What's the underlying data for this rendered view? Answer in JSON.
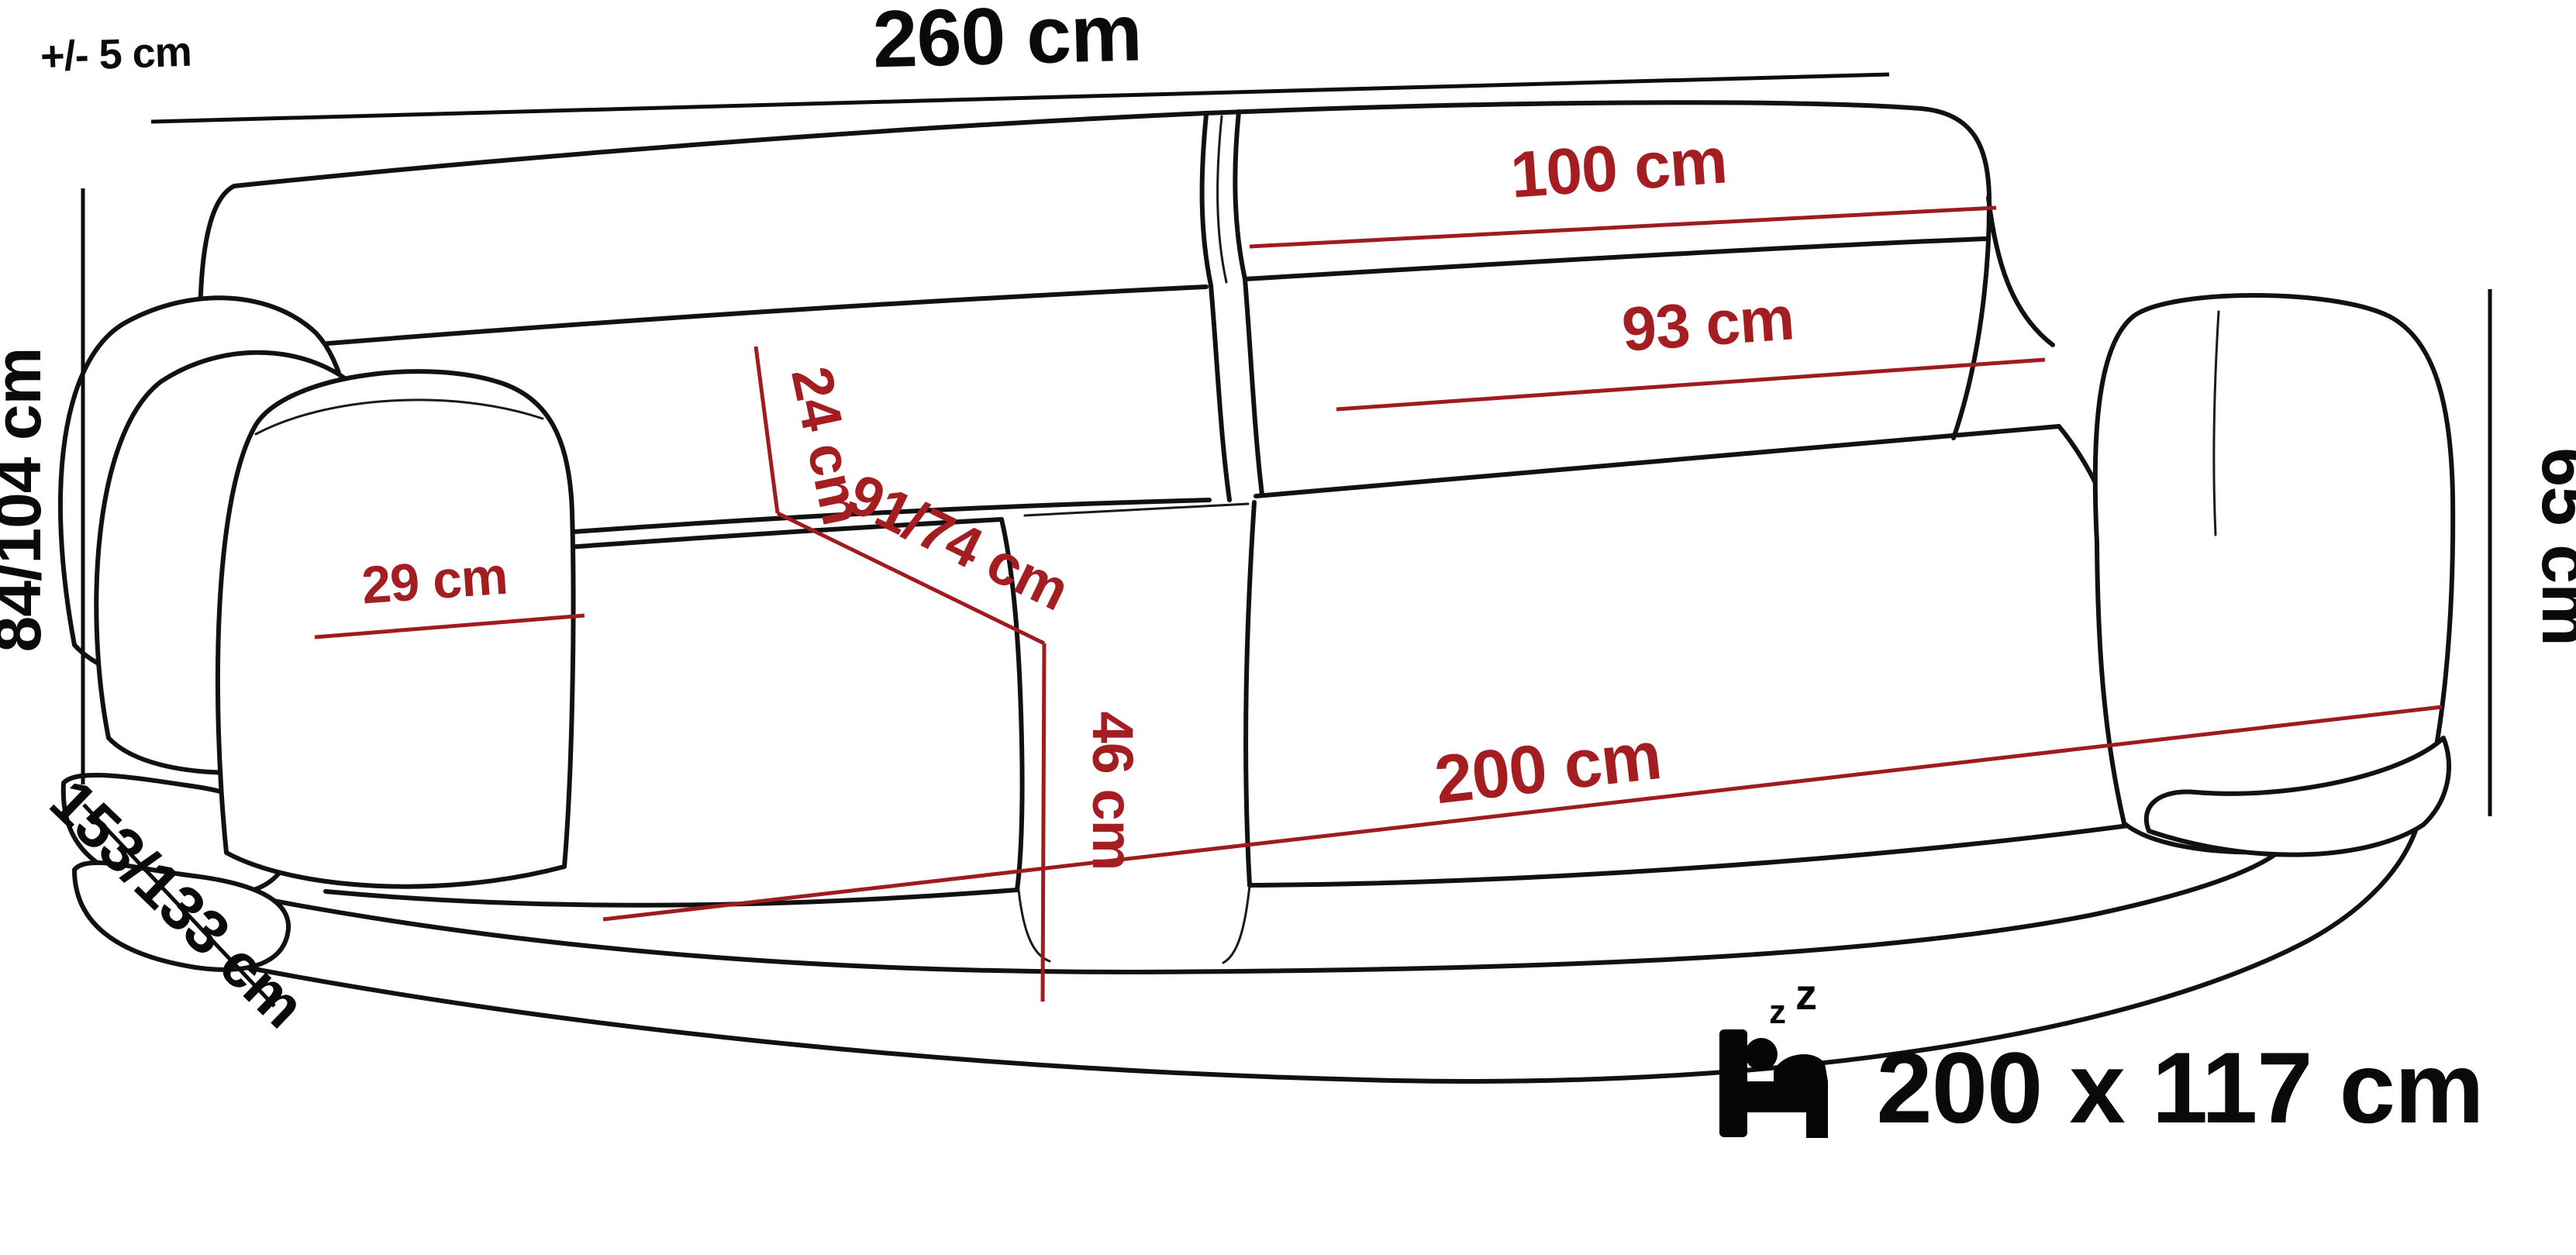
{
  "labels": {
    "tolerance": "+/- 5 cm",
    "width_total": "260 cm",
    "height_range": "84/104 cm",
    "depth_range": "153/133 cm",
    "arm_height": "65 cm",
    "headrest_width": "100 cm",
    "backrest_width": "93 cm",
    "armrest_width": "29 cm",
    "headrest_height": "24 cm",
    "seat_depth": "91/74 cm",
    "seat_height": "46 cm",
    "seat_width": "200 cm",
    "sleeping_area": "200 x 117 cm",
    "zzz_small": "z",
    "zzz_large": "z"
  },
  "colors": {
    "background": "#ffffff",
    "line_black": "#111111",
    "text_black": "#0a0a0a",
    "red_text": "#a31d21",
    "red_line": "#9e1b1e"
  },
  "icons": {
    "sleeping_bed": "sleeping-bed-icon"
  }
}
